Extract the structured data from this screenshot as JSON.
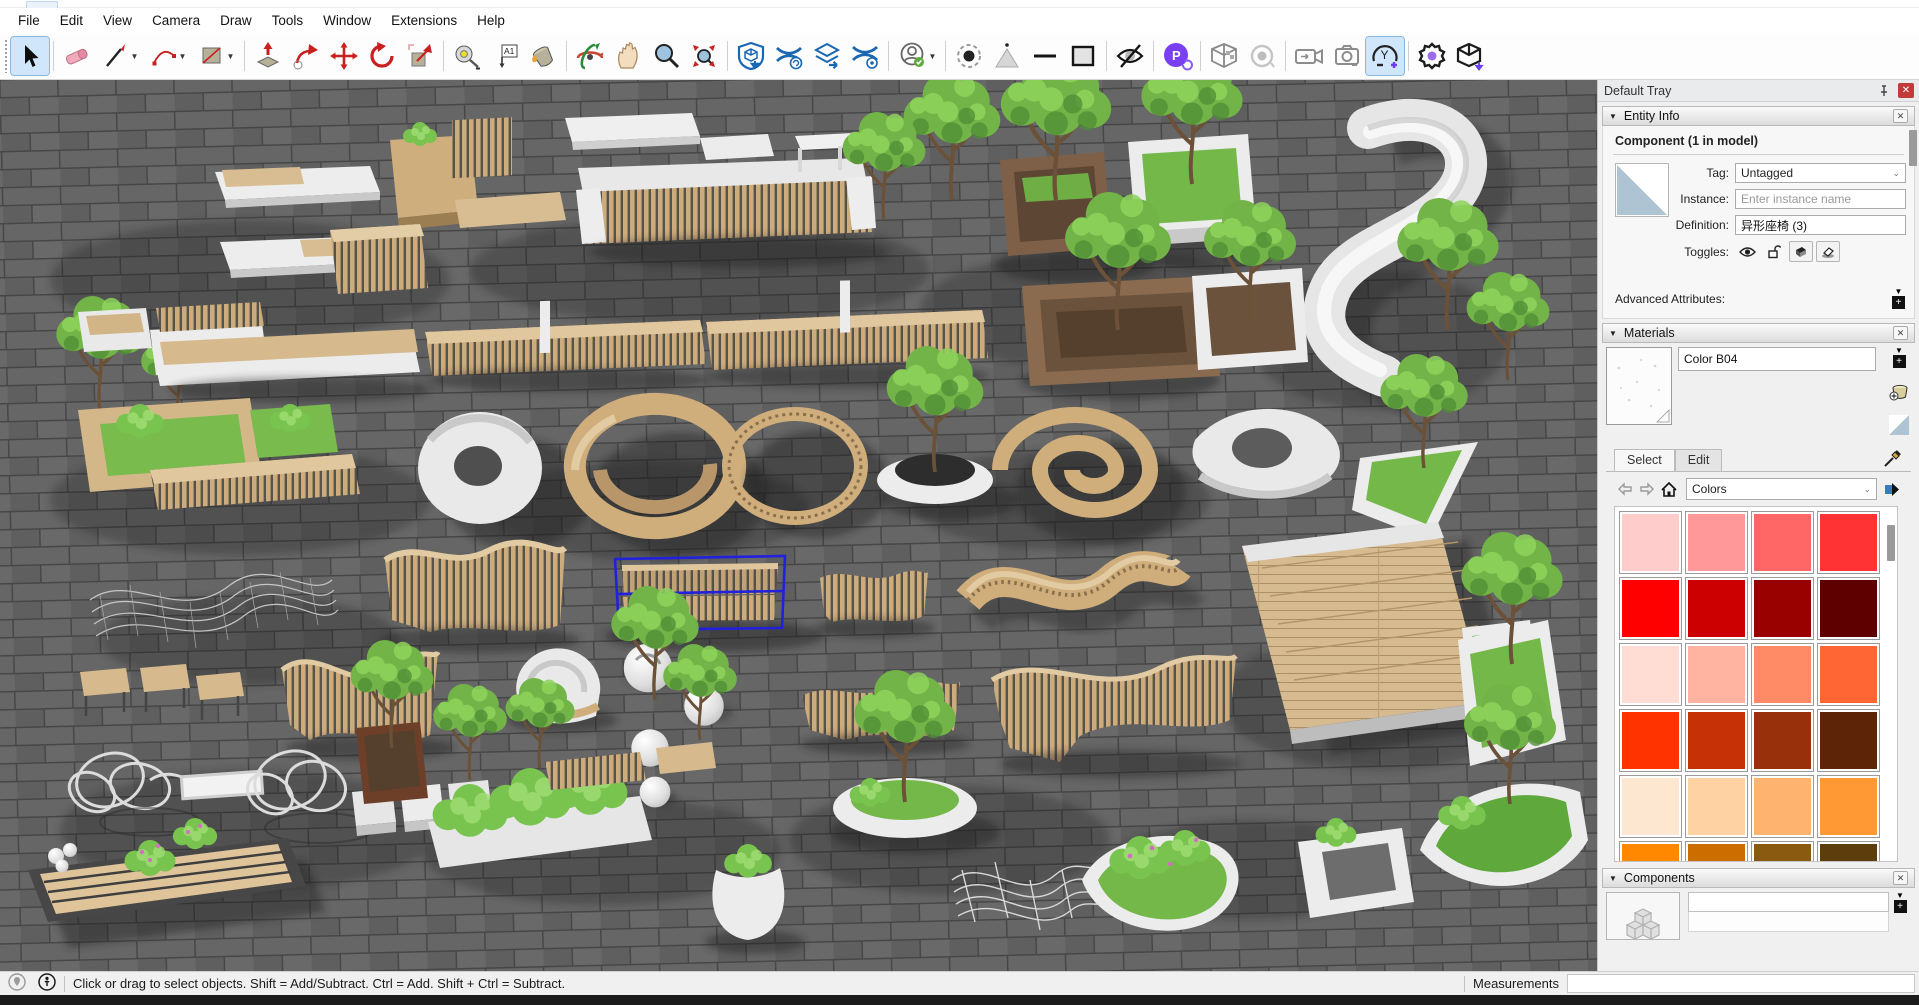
{
  "menu_bar": {
    "items": [
      "File",
      "Edit",
      "View",
      "Camera",
      "Draw",
      "Tools",
      "Window",
      "Extensions",
      "Help"
    ]
  },
  "toolbar": {
    "icons": [
      "select",
      "eraser",
      "line",
      "arc",
      "shapes",
      "push-pull",
      "follow-me",
      "move",
      "rotate",
      "scale",
      "tape-measure",
      "text",
      "paint-bucket",
      "orbit",
      "pan",
      "zoom",
      "zoom-extents",
      "3d-warehouse",
      "share-model",
      "share-component",
      "extension-warehouse",
      "account",
      "x-ray",
      "back-edges",
      "wireframe",
      "hidden-line",
      "monochrome",
      "podium",
      "section-cube",
      "section-rotate",
      "animation-camera",
      "scene-camera",
      "camera-add",
      "render-settings",
      "export-model"
    ],
    "text_tool_glyph": "A1",
    "podium_glyph": "P",
    "camera_y_glyph": "Y"
  },
  "tray": {
    "title": "Default Tray",
    "entity_info": {
      "title": "Entity Info",
      "component_label": "Component (1 in model)",
      "tag_label": "Tag:",
      "tag_value": "Untagged",
      "instance_label": "Instance:",
      "instance_placeholder": "Enter instance name",
      "definition_label": "Definition:",
      "definition_value": "异形座椅 (3)",
      "toggles_label": "Toggles:",
      "advanced_attributes_label": "Advanced Attributes:"
    },
    "materials": {
      "title": "Materials",
      "material_name": "Color B04",
      "tabs": [
        "Select",
        "Edit"
      ],
      "collection_value": "Colors",
      "swatches": [
        "#ffcccc",
        "#ff9999",
        "#ff6666",
        "#ff3333",
        "#ff0000",
        "#cc0000",
        "#990000",
        "#5e0000",
        "#ffddd4",
        "#ffb3a0",
        "#ff8a66",
        "#ff6633",
        "#ff3300",
        "#c63206",
        "#97300b",
        "#5e2408",
        "#fde7d0",
        "#ffd2a4",
        "#feb36e",
        "#fe9933",
        "#ff8800",
        "#cc6d00",
        "#8a5a10",
        "#5e3d0d"
      ]
    },
    "components": {
      "title": "Components"
    }
  },
  "status_bar": {
    "hint": "Click or drag to select objects. Shift = Add/Subtract. Ctrl = Add. Shift + Ctrl = Subtract.",
    "measurements_label": "Measurements",
    "measurements_value": ""
  },
  "viewport": {
    "selected_component": "异形座椅 (3)",
    "selection_color": "#2121dd"
  }
}
